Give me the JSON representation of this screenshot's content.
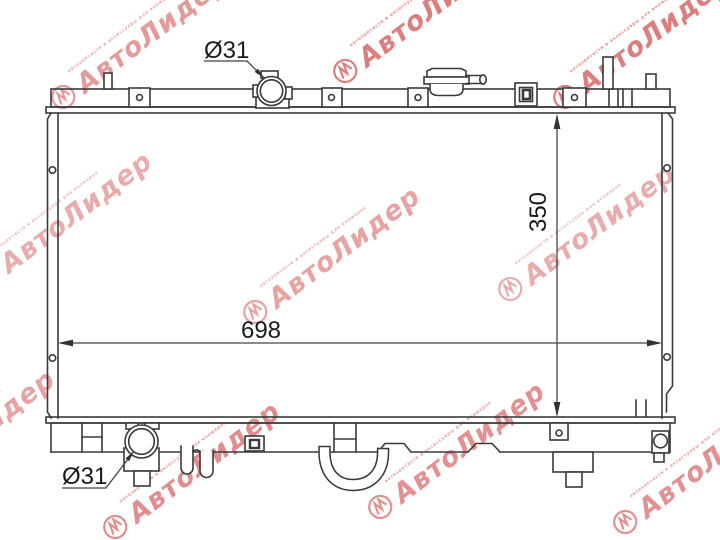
{
  "drawing": {
    "dimensions": {
      "core_width": "698",
      "core_height": "350",
      "inlet_diameter": "Ø31",
      "outlet_diameter": "Ø31"
    },
    "line_color": "#3a3a3a",
    "text_color": "#1a1a1a"
  },
  "watermark": {
    "brand": "АвтоЛидер",
    "tagline": "автозапчасти и аксессуары для иномарок",
    "color": "#d04848"
  }
}
